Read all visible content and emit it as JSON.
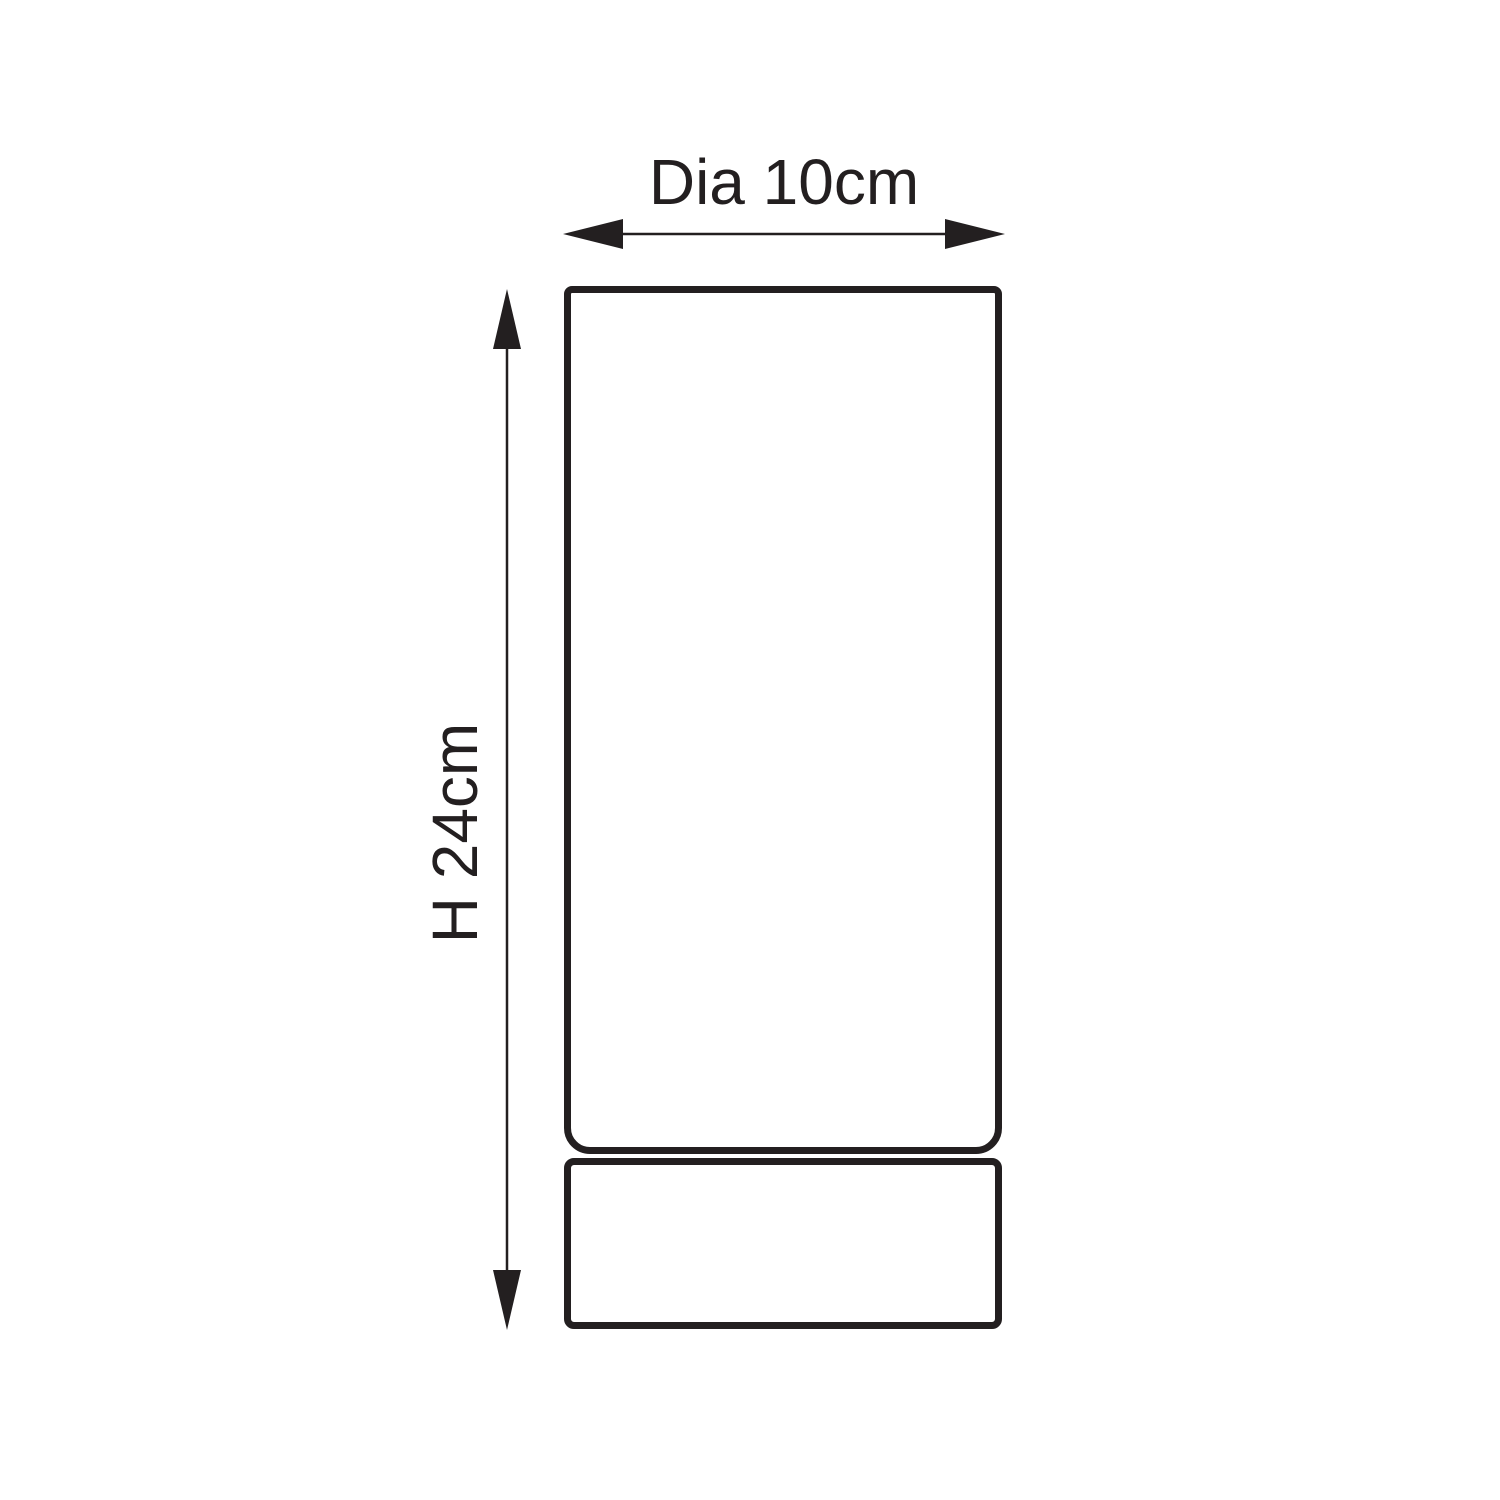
{
  "drawing": {
    "type": "product-dimension-diagram",
    "background_color": "#ffffff",
    "line_color": "#231f20",
    "dimensions": {
      "width_label": "Dia 10cm",
      "height_label": "H 24cm"
    }
  }
}
